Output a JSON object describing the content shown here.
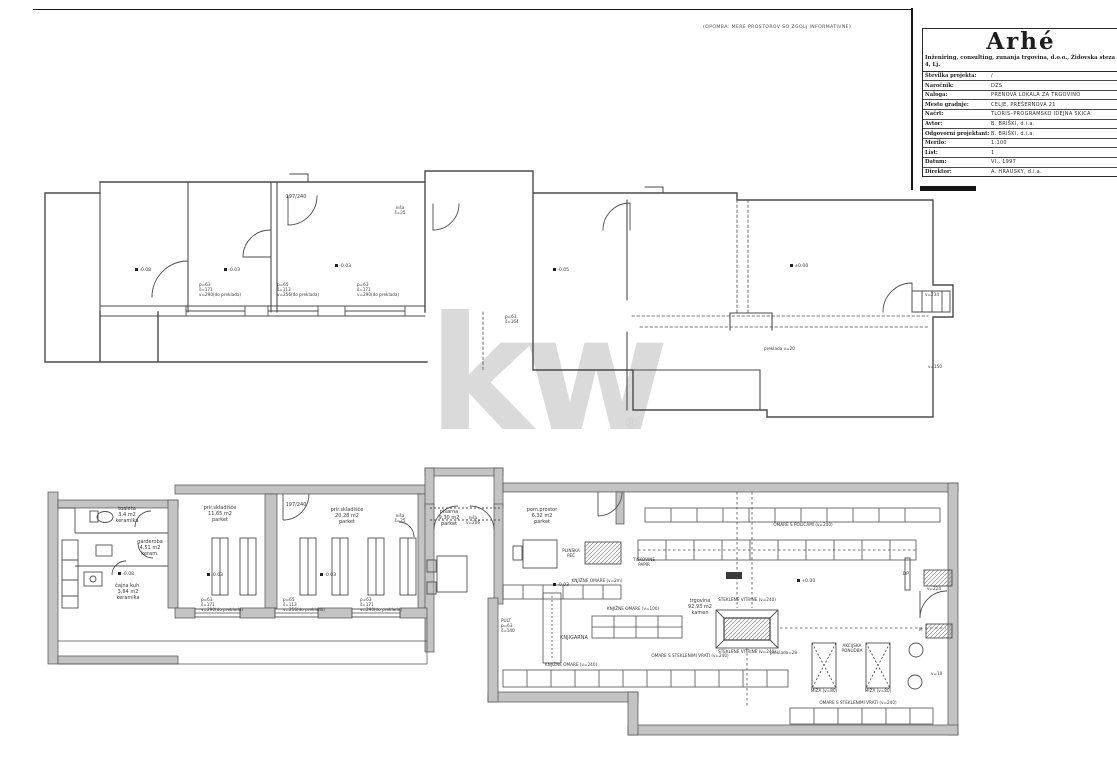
{
  "meta": {
    "note": "(OPOMBA: MERE PROSTOROV SO ZGOLJ INFORMATIVNE)"
  },
  "watermark": {
    "text": "kw",
    "registered": "®",
    "color": "#dadada"
  },
  "title_block": {
    "logo": "Arhé",
    "subtitle": "Inženiring, consulting, zunanja trgovina, d.o.o., Židovska steza 4, Lj.",
    "rows": [
      {
        "label": "Številka projekta:",
        "value": "/"
      },
      {
        "label": "Naročnik:",
        "value": "DZS"
      },
      {
        "label": "Naloga:",
        "value": "PRENOVA LOKALA ZA TRGOVINO"
      },
      {
        "label": "Mesto gradnje:",
        "value": "CELJE, PREŠERNOVA 21"
      },
      {
        "label": "Načrt:",
        "value": "TLORIS–PROGRAMSKO IDEJNA SKICA"
      },
      {
        "label": "Avtor:",
        "value": "B. BRIŠKI, d.i.a."
      },
      {
        "label": "Odgovorni projektant:",
        "value": "B. BRIŠKI, d.i.a."
      },
      {
        "label": "Merilo:",
        "value": "1:100"
      },
      {
        "label": "List:",
        "value": "1"
      },
      {
        "label": "Datum:",
        "value": "VI., 1997"
      },
      {
        "label": "Direktor:",
        "value": "A. HRAUSKY, d.i.a."
      }
    ]
  },
  "plan_labels": [
    {
      "x": 296,
      "y": 195,
      "cls": "c s5",
      "lines": [
        "197/240"
      ]
    },
    {
      "x": 400,
      "y": 206,
      "cls": "c s4",
      "lines": [
        "niša",
        "š=25"
      ]
    },
    {
      "x": 135,
      "y": 268,
      "cls": "elev",
      "lines": [
        "-0.08"
      ]
    },
    {
      "x": 224,
      "y": 268,
      "cls": "elev",
      "lines": [
        "-0.03"
      ]
    },
    {
      "x": 335,
      "y": 264,
      "cls": "elev",
      "lines": [
        "-0.03"
      ]
    },
    {
      "x": 553,
      "y": 268,
      "cls": "elev",
      "lines": [
        "-0.05"
      ]
    },
    {
      "x": 790,
      "y": 264,
      "cls": "elev",
      "lines": [
        "±0.00"
      ]
    },
    {
      "x": 199,
      "y": 283,
      "cls": "win",
      "lines": [
        "p=63",
        "š=171",
        "v=290(do preklada)"
      ]
    },
    {
      "x": 277,
      "y": 283,
      "cls": "win",
      "lines": [
        "p=65",
        "š=113",
        "v=256(do preklada)"
      ]
    },
    {
      "x": 357,
      "y": 283,
      "cls": "win",
      "lines": [
        "p=63",
        "š=171",
        "v=290(do preklada)"
      ]
    },
    {
      "x": 505,
      "y": 315,
      "cls": "win",
      "lines": [
        "p=63",
        "š=164"
      ]
    },
    {
      "x": 764,
      "y": 347,
      "cls": "win",
      "lines": [
        "preklada v=20"
      ]
    },
    {
      "x": 925,
      "y": 293,
      "cls": "win",
      "lines": [
        "v=234"
      ]
    },
    {
      "x": 928,
      "y": 365,
      "cls": "win",
      "lines": [
        "v=150"
      ]
    },
    {
      "x": 127,
      "y": 507,
      "cls": "c s5",
      "lines": [
        "toaleta",
        "3,4 m2",
        "keramika"
      ]
    },
    {
      "x": 150,
      "y": 540,
      "cls": "c s5",
      "lines": [
        "garderoba",
        "4,51 m2",
        "keram."
      ]
    },
    {
      "x": 118,
      "y": 572,
      "cls": "elev",
      "lines": [
        "-0.08"
      ]
    },
    {
      "x": 128,
      "y": 584,
      "cls": "c s5",
      "lines": [
        "čajna kuh.",
        "3,64 m2",
        "keramika"
      ]
    },
    {
      "x": 220,
      "y": 506,
      "cls": "c s5",
      "lines": [
        "prir.skladišče",
        "11,65 m2",
        "parket"
      ]
    },
    {
      "x": 207,
      "y": 573,
      "cls": "elev",
      "lines": [
        "-0.03"
      ]
    },
    {
      "x": 296,
      "y": 503,
      "cls": "c s5",
      "lines": [
        "197/240"
      ]
    },
    {
      "x": 347,
      "y": 508,
      "cls": "c s5",
      "lines": [
        "prir.skladišče",
        "20,28 m2",
        "parket"
      ]
    },
    {
      "x": 320,
      "y": 573,
      "cls": "elev",
      "lines": [
        "-0.03"
      ]
    },
    {
      "x": 400,
      "y": 514,
      "cls": "c s4",
      "lines": [
        "niša",
        "š=25"
      ]
    },
    {
      "x": 449,
      "y": 510,
      "cls": "c s5",
      "lines": [
        "pisarna",
        "9,30 m2",
        "parket"
      ]
    },
    {
      "x": 473,
      "y": 516,
      "cls": "c s4",
      "lines": [
        "niša",
        "v=206"
      ]
    },
    {
      "x": 542,
      "y": 508,
      "cls": "c s5",
      "lines": [
        "pom.prostor",
        "6,32 m2",
        "parket"
      ]
    },
    {
      "x": 571,
      "y": 549,
      "cls": "c s4",
      "lines": [
        "PLINSKA",
        "PEČ"
      ]
    },
    {
      "x": 644,
      "y": 558,
      "cls": "c s4",
      "lines": [
        "TISKOVINE",
        "PAPIR"
      ]
    },
    {
      "x": 553,
      "y": 583,
      "cls": "elev",
      "lines": [
        "-0.03"
      ]
    },
    {
      "x": 597,
      "y": 579,
      "cls": "c s4",
      "lines": [
        "KNJIŽNE OMARE (v=2m)"
      ]
    },
    {
      "x": 803,
      "y": 523,
      "cls": "c s4",
      "lines": [
        "OMARE S POLICAMI (v=240)"
      ]
    },
    {
      "x": 797,
      "y": 579,
      "cls": "elev",
      "lines": [
        "+0.00"
      ]
    },
    {
      "x": 700,
      "y": 599,
      "cls": "c s5",
      "lines": [
        "trgovina",
        "92,93 m2",
        "kamen"
      ]
    },
    {
      "x": 747,
      "y": 598,
      "cls": "c s4",
      "lines": [
        "STEKLENE VITRINE (v=240)"
      ]
    },
    {
      "x": 747,
      "y": 650,
      "cls": "c s4",
      "lines": [
        "STEKLENE VITRINE (v=240)"
      ]
    },
    {
      "x": 633,
      "y": 607,
      "cls": "c s4",
      "lines": [
        "KNJIŽNE OMARE (v=100)"
      ]
    },
    {
      "x": 574,
      "y": 636,
      "cls": "c s5",
      "lines": [
        "KNJIGARNA"
      ]
    },
    {
      "x": 501,
      "y": 619,
      "cls": "win",
      "lines": [
        "PULT",
        "p=63",
        "š=140"
      ]
    },
    {
      "x": 201,
      "y": 598,
      "cls": "win",
      "lines": [
        "p=63",
        "š=171",
        "v=290(do preklada)"
      ]
    },
    {
      "x": 283,
      "y": 598,
      "cls": "win",
      "lines": [
        "p=65",
        "š=113",
        "v=256(do preklada)"
      ]
    },
    {
      "x": 360,
      "y": 598,
      "cls": "win",
      "lines": [
        "p=63",
        "š=171",
        "v=290(do preklada)"
      ]
    },
    {
      "x": 571,
      "y": 663,
      "cls": "c s4",
      "lines": [
        "KNJIŽNE OMARE (v=240)"
      ]
    },
    {
      "x": 690,
      "y": 654,
      "cls": "c s4",
      "lines": [
        "OMARE S STEKLENIMI VRATI (v=240)"
      ]
    },
    {
      "x": 770,
      "y": 651,
      "cls": "win",
      "lines": [
        "preklada=28"
      ]
    },
    {
      "x": 852,
      "y": 644,
      "cls": "c s4",
      "lines": [
        "AKCIJSKA",
        "PONUDBA"
      ]
    },
    {
      "x": 824,
      "y": 689,
      "cls": "c s4",
      "lines": [
        "MIZA (v=80)"
      ]
    },
    {
      "x": 878,
      "y": 689,
      "cls": "c s4",
      "lines": [
        "MIZA (v=80)"
      ]
    },
    {
      "x": 858,
      "y": 701,
      "cls": "c s4",
      "lines": [
        "OMARE S STEKLENIMI VRATI (v=240)"
      ]
    },
    {
      "x": 903,
      "y": 572,
      "cls": "win",
      "lines": [
        "DP"
      ]
    },
    {
      "x": 927,
      "y": 587,
      "cls": "win",
      "lines": [
        "v=224"
      ]
    },
    {
      "x": 919,
      "y": 628,
      "cls": "win",
      "lines": [
        "M"
      ]
    },
    {
      "x": 931,
      "y": 672,
      "cls": "win",
      "lines": [
        "v=10"
      ]
    }
  ]
}
